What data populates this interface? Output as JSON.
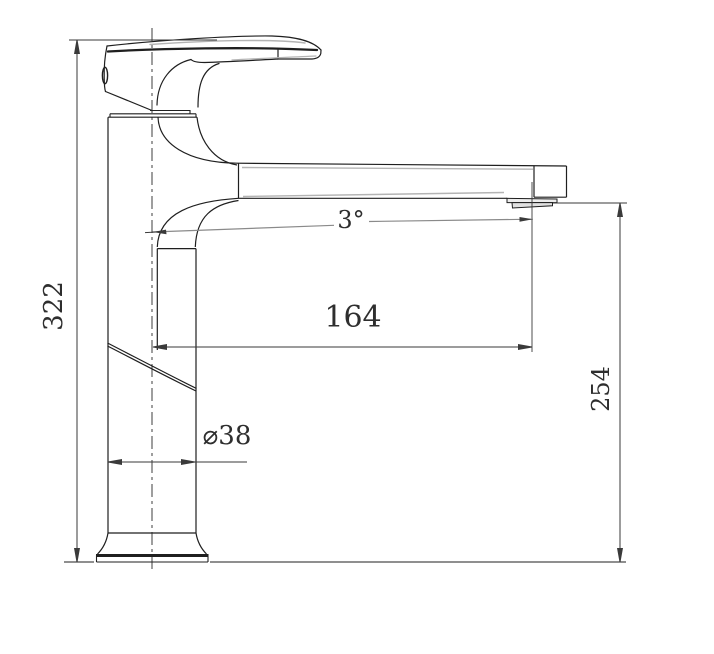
{
  "drawing": {
    "kind": "technical-dimension-drawing",
    "subject": "single-lever basin mixer faucet, side elevation",
    "labels": {
      "overall_height": "322",
      "spout_reach": "164",
      "spout_outlet_height": "254",
      "body_diameter": "⌀38",
      "spout_angle": "3°"
    },
    "colors": {
      "line": "#1f1f1f",
      "shade": "#b4b4b4",
      "dimension": "#3a3a3a",
      "background": "#ffffff"
    }
  }
}
